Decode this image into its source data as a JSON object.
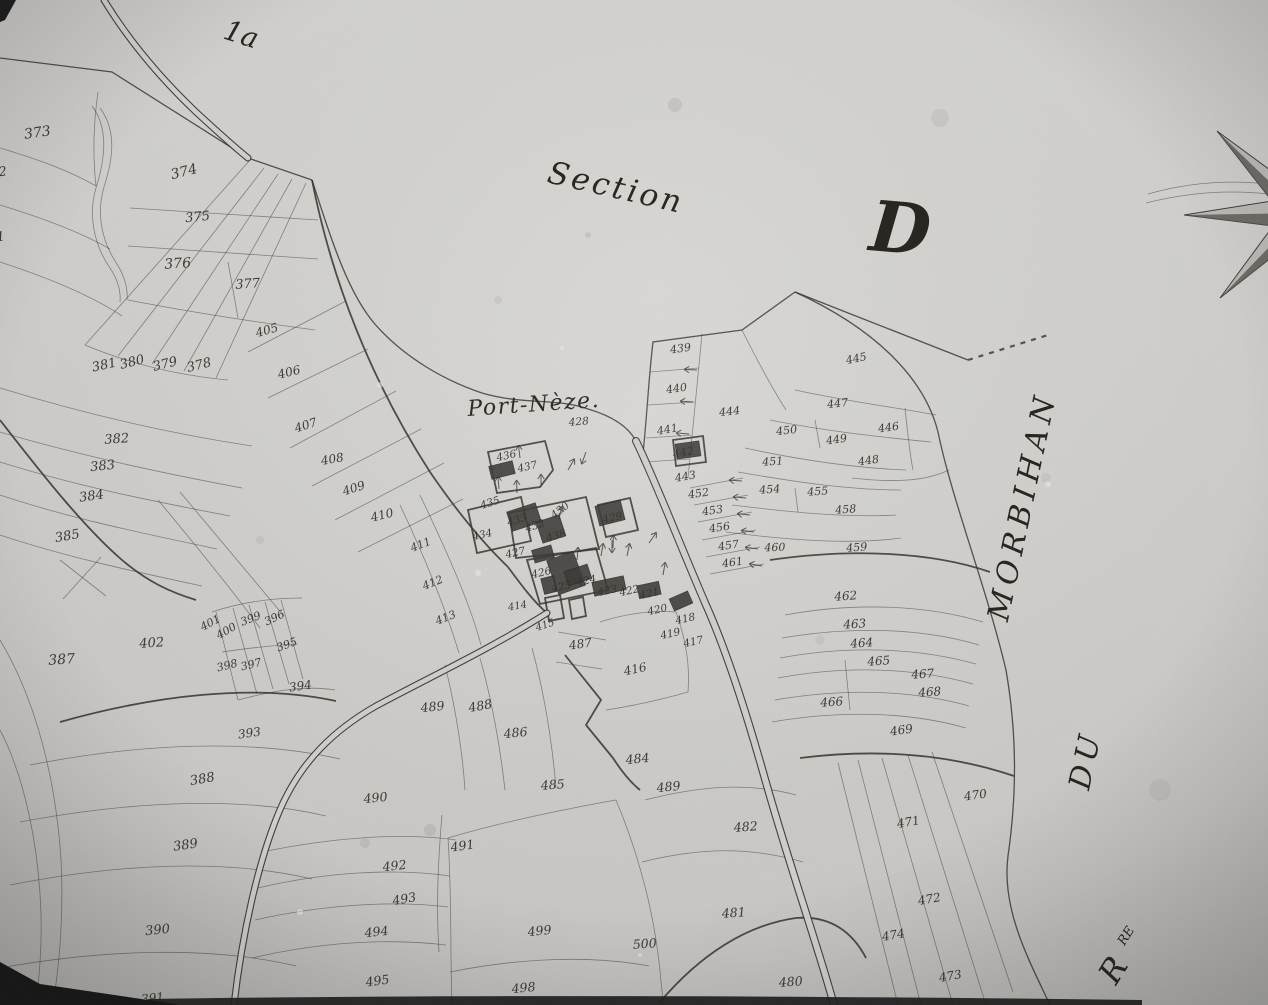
{
  "map": {
    "corner_label": "1a",
    "section_label": "Section",
    "section_letter": "D",
    "place_name": "Port-Nèze.",
    "place_parcel": "428",
    "water_name_morbihan": "MORBIHAN",
    "water_name_du": "DU",
    "water_name_r": "R",
    "water_name_r_sup": "RE"
  },
  "colors": {
    "paper": "#d3d2cf",
    "ink": "#2d2b27",
    "accent_dark": "#161616"
  },
  "parcels": [
    [
      "373",
      38,
      137,
      -8,
      14
    ],
    [
      "374",
      185,
      176,
      -14,
      14
    ],
    [
      "375",
      198,
      221,
      -6,
      13
    ],
    [
      "376",
      178,
      268,
      -4,
      14
    ],
    [
      "377",
      248,
      288,
      -4,
      13
    ],
    [
      "372",
      -5,
      177,
      -8,
      13
    ],
    [
      "371",
      -7,
      242,
      -8,
      13
    ],
    [
      "381",
      105,
      369,
      -12,
      13
    ],
    [
      "380",
      133,
      366,
      -14,
      13
    ],
    [
      "379",
      166,
      368,
      -14,
      13
    ],
    [
      "378",
      200,
      369,
      -14,
      13
    ],
    [
      "382",
      117,
      443,
      -4,
      13
    ],
    [
      "383",
      103,
      470,
      -6,
      13
    ],
    [
      "384",
      92,
      500,
      -8,
      13
    ],
    [
      "385",
      68,
      540,
      -10,
      13
    ],
    [
      "387",
      62,
      664,
      -4,
      14
    ],
    [
      "402",
      152,
      647,
      -4,
      13
    ],
    [
      "401",
      212,
      626,
      -28,
      11
    ],
    [
      "400",
      228,
      634,
      -30,
      11
    ],
    [
      "399",
      252,
      622,
      -22,
      11
    ],
    [
      "396",
      276,
      621,
      -26,
      11
    ],
    [
      "395",
      288,
      648,
      -20,
      11
    ],
    [
      "398",
      228,
      669,
      -14,
      11
    ],
    [
      "397",
      252,
      668,
      -14,
      11
    ],
    [
      "394",
      301,
      690,
      -8,
      12
    ],
    [
      "393",
      250,
      737,
      -8,
      12
    ],
    [
      "388",
      203,
      783,
      -10,
      13
    ],
    [
      "389",
      186,
      849,
      -8,
      13
    ],
    [
      "390",
      158,
      934,
      -6,
      13
    ],
    [
      "391",
      153,
      1002,
      -6,
      12
    ],
    [
      "405",
      268,
      334,
      -16,
      12
    ],
    [
      "406",
      290,
      376,
      -14,
      12
    ],
    [
      "407",
      307,
      429,
      -18,
      12
    ],
    [
      "408",
      333,
      463,
      -10,
      12
    ],
    [
      "409",
      355,
      492,
      -18,
      12
    ],
    [
      "410",
      383,
      519,
      -14,
      12
    ],
    [
      "411",
      422,
      548,
      -22,
      11
    ],
    [
      "412",
      434,
      586,
      -22,
      11
    ],
    [
      "413",
      447,
      621,
      -22,
      11
    ],
    [
      "414",
      518,
      609,
      -10,
      10
    ],
    [
      "415",
      546,
      628,
      -18,
      10
    ],
    [
      "416",
      636,
      673,
      -12,
      12
    ],
    [
      "435",
      491,
      506,
      -18,
      10.5
    ],
    [
      "436",
      507,
      459,
      -12,
      10.5
    ],
    [
      "437",
      528,
      470,
      -12,
      10.5
    ],
    [
      "434",
      483,
      538,
      -12,
      10.5
    ],
    [
      "433",
      518,
      523,
      -18,
      10.5
    ],
    [
      "432",
      536,
      529,
      -18,
      10.5
    ],
    [
      "438",
      557,
      539,
      -18,
      10.5
    ],
    [
      "430",
      562,
      513,
      -38,
      10.5
    ],
    [
      "429",
      613,
      521,
      -12,
      10.5
    ],
    [
      "427",
      516,
      556,
      -12,
      10.5
    ],
    [
      "426",
      542,
      576,
      -12,
      10.5
    ],
    [
      "425",
      562,
      590,
      -12,
      10.5
    ],
    [
      "424",
      587,
      584,
      -12,
      10.5
    ],
    [
      "423",
      608,
      594,
      -12,
      10.5
    ],
    [
      "422",
      630,
      594,
      -12,
      10.5
    ],
    [
      "421",
      650,
      597,
      -12,
      10.5
    ],
    [
      "420",
      658,
      613,
      -12,
      10.5
    ],
    [
      "419",
      671,
      637,
      -12,
      10.5
    ],
    [
      "418",
      686,
      622,
      -12,
      10.5
    ],
    [
      "417",
      694,
      645,
      -12,
      10.5
    ],
    [
      "428",
      579,
      425,
      -4,
      10.5
    ],
    [
      "439",
      681,
      352,
      -8,
      11
    ],
    [
      "440",
      677,
      392,
      -8,
      11
    ],
    [
      "441",
      668,
      433,
      -10,
      11
    ],
    [
      "442",
      684,
      456,
      -10,
      11
    ],
    [
      "443",
      686,
      480,
      -10,
      11
    ],
    [
      "444",
      730,
      415,
      -6,
      11
    ],
    [
      "445",
      857,
      362,
      -12,
      11
    ],
    [
      "446",
      889,
      431,
      -8,
      11
    ],
    [
      "447",
      838,
      407,
      -6,
      11
    ],
    [
      "448",
      869,
      464,
      -8,
      11
    ],
    [
      "449",
      837,
      443,
      -8,
      11
    ],
    [
      "450",
      787,
      434,
      -6,
      11
    ],
    [
      "451",
      773,
      465,
      -4,
      11
    ],
    [
      "452",
      699,
      497,
      -8,
      11
    ],
    [
      "453",
      713,
      514,
      -8,
      11
    ],
    [
      "454",
      770,
      493,
      -4,
      11
    ],
    [
      "455",
      818,
      495,
      -4,
      11
    ],
    [
      "456",
      720,
      531,
      -8,
      11
    ],
    [
      "457",
      729,
      549,
      -8,
      11
    ],
    [
      "458",
      846,
      513,
      -4,
      11
    ],
    [
      "459",
      857,
      551,
      -4,
      11
    ],
    [
      "460",
      775,
      551,
      -2,
      11
    ],
    [
      "461",
      733,
      566,
      -8,
      11
    ],
    [
      "462",
      846,
      600,
      -4,
      12
    ],
    [
      "463",
      855,
      628,
      -4,
      12
    ],
    [
      "464",
      862,
      647,
      -4,
      12
    ],
    [
      "465",
      879,
      665,
      -4,
      12
    ],
    [
      "466",
      832,
      706,
      -4,
      12
    ],
    [
      "467",
      923,
      678,
      -4,
      12
    ],
    [
      "468",
      930,
      696,
      -4,
      12
    ],
    [
      "469",
      902,
      734,
      -8,
      12
    ],
    [
      "470",
      976,
      799,
      -8,
      12
    ],
    [
      "471",
      909,
      826,
      -10,
      12
    ],
    [
      "472",
      930,
      903,
      -10,
      12
    ],
    [
      "473",
      951,
      980,
      -10,
      12
    ],
    [
      "474",
      894,
      939,
      -10,
      12
    ],
    [
      "480",
      791,
      986,
      -4,
      12.5
    ],
    [
      "481",
      734,
      917,
      -4,
      12.5
    ],
    [
      "482",
      746,
      831,
      -4,
      12.5
    ],
    [
      "484",
      638,
      763,
      -6,
      12.5
    ],
    [
      "485",
      553,
      789,
      -4,
      12.5
    ],
    [
      "486",
      516,
      737,
      -6,
      12.5
    ],
    [
      "487",
      581,
      648,
      -8,
      12
    ],
    [
      "488",
      481,
      710,
      -10,
      12.5
    ],
    [
      "489",
      433,
      711,
      -6,
      12.5
    ],
    [
      "489",
      669,
      791,
      -6,
      12.5
    ],
    [
      "490",
      376,
      802,
      -6,
      12.5
    ],
    [
      "491",
      463,
      850,
      -8,
      12.5
    ],
    [
      "492",
      395,
      870,
      -6,
      12.5
    ],
    [
      "493",
      405,
      903,
      -10,
      12.5
    ],
    [
      "494",
      377,
      936,
      -6,
      12.5
    ],
    [
      "495",
      378,
      985,
      -8,
      12.5
    ],
    [
      "498",
      524,
      992,
      -6,
      12.5
    ],
    [
      "499",
      540,
      935,
      -6,
      12.5
    ],
    [
      "500",
      645,
      948,
      -4,
      12.5
    ]
  ],
  "geometry": {
    "coast": [
      "M 0,58 L 112,72 L 248,158 L 312,180",
      "M 312,180 C 332,242 348,292 374,323 C 404,358 446,381 482,393 C 522,405 558,398 588,409 C 612,416 628,426 636,441 L 642,462",
      "M 642,462 C 647,420 648,384 653,342 L 742,330 L 795,292",
      "M 795,292 C 858,317 930,345 968,360",
      "M 795,292 C 878,330 925,380 938,432 C 952,500 986,586 1006,670 C 1018,740 1016,800 1008,856 C 1001,910 1030,962 1050,1005"
    ],
    "thin": [
      "M 0,148 C 40,160 70,171 96,186",
      "M 0,205 C 46,219 82,233 110,249",
      "M 0,262 C 52,279 92,296 122,316",
      "M 96,186 C 92,150 94,120 98,92",
      "M 130,208 L 318,220",
      "M 128,246 L 318,259",
      "M 228,262 L 238,318",
      "M 128,300 C 190,312 255,322 315,330",
      "M 250,160 L 85,345",
      "M 264,168 L 118,356",
      "M 278,174 L 152,364",
      "M 292,179 L 184,371",
      "M 306,183 L 216,378",
      "M 85,345 C 135,366 185,376 228,380",
      "M 0,388 C 85,414 172,434 252,446",
      "M 0,432 C 82,456 162,473 242,488",
      "M 0,462 C 76,486 152,501 230,516",
      "M 0,495 C 72,519 142,533 217,549",
      "M 0,535 C 66,557 132,571 202,586",
      "M 158,500 C 198,548 232,590 260,628",
      "M 180,492 C 220,540 254,580 284,616",
      "M 212,612 C 242,602 272,598 302,598",
      "M 216,612 L 238,700",
      "M 233,608 L 257,694",
      "M 249,605 L 273,689",
      "M 265,602 L 289,684",
      "M 281,600 L 303,679",
      "M 222,652 C 250,648 275,645 298,644",
      "M 238,700 C 272,691 305,685 335,690",
      "M 30,765 C 142,743 252,739 340,759",
      "M 20,822 C 132,801 242,796 326,816",
      "M 10,885 C 122,863 227,859 312,879",
      "M 0,968 C 106,949 212,946 296,966",
      "M 0,640 C 36,700 56,780 61,860 C 64,920 59,965 53,1005",
      "M 0,730 C 26,780 39,850 41,915 C 42,950 39,980 36,1005",
      "M 60,560 L 106,596",
      "M 101,557 L 63,599",
      "M 100,108 C 118,132 112,162 104,187 C 96,214 102,242 117,264 C 125,277 128,289 127,300",
      "M 92,106 C 110,130 104,162 96,188 C 88,215 94,245 110,268 C 118,280 121,291 120,302",
      "M 248,352 L 346,301",
      "M 268,398 L 368,349",
      "M 290,448 L 396,391",
      "M 312,486 L 421,429",
      "M 335,520 L 444,463",
      "M 358,552 L 463,499",
      "M 400,505 C 426,560 446,610 459,653",
      "M 420,495 C 446,550 469,600 481,645",
      "M 445,665 C 455,706 462,746 465,790",
      "M 480,658 C 492,701 500,746 505,790",
      "M 532,648 C 545,696 552,741 556,788",
      "M 558,632 L 606,640",
      "M 556,662 L 602,669",
      "M 262,852 C 330,838 400,832 456,840",
      "M 258,888 C 325,872 395,868 450,876",
      "M 255,920 C 322,905 392,900 448,907",
      "M 252,958 C 320,942 390,938 446,945",
      "M 442,815 C 438,862 436,906 439,952",
      "M 448,838 C 502,822 560,810 616,800",
      "M 448,838 C 452,900 450,950 452,1005",
      "M 616,800 C 641,860 656,920 661,982 C 662,990 663,1000 663,1005",
      "M 450,972 C 520,958 590,955 649,966",
      "M 702,334 C 697,386 692,436 688,478",
      "M 650,372 L 699,368",
      "M 648,405 L 695,402",
      "M 646,438 L 691,435",
      "M 645,462 L 689,459",
      "M 795,390 C 850,402 900,408 936,415",
      "M 770,420 C 830,432 890,438 931,442",
      "M 905,408 C 908,436 910,456 913,470",
      "M 815,420 L 820,448",
      "M 852,478 C 896,483 926,481 949,470",
      "M 745,448 C 800,460 856,468 906,470",
      "M 738,472 C 795,482 850,490 901,490",
      "M 732,505 C 790,512 846,518 896,515",
      "M 726,532 C 788,540 849,545 901,538",
      "M 795,488 L 798,512",
      "M 742,330 C 758,362 772,388 786,410",
      "M 690,488 L 743,478",
      "M 694,505 L 748,495",
      "M 698,522 L 752,512",
      "M 702,540 L 756,530",
      "M 706,557 L 760,547",
      "M 710,574 L 764,564",
      "M 785,615 C 856,602 926,605 983,622",
      "M 782,638 C 852,626 922,628 979,645",
      "M 780,658 C 850,645 918,648 976,664",
      "M 778,678 C 848,665 915,668 973,684",
      "M 775,700 C 845,688 912,690 969,706",
      "M 845,660 L 850,710",
      "M 772,722 C 842,710 910,712 966,728",
      "M 838,763 L 898,1005",
      "M 858,760 L 921,1005",
      "M 882,758 L 953,1005",
      "M 908,755 L 986,1005",
      "M 932,752 L 1013,992",
      "M 645,800 C 700,786 748,782 796,795",
      "M 642,862 C 698,848 748,846 803,862",
      "M 600,622 C 625,614 650,610 676,612",
      "M 676,612 C 686,640 690,665 688,692",
      "M 688,692 C 660,700 632,706 606,710",
      "M 1148,194 C 1190,182 1230,180 1268,184",
      "M 1146,203 C 1190,192 1232,190 1268,194"
    ],
    "bold": [
      "M 60,722 C 152,696 252,683 336,701",
      "M 0,420 C 45,478 85,528 122,560 C 148,582 170,592 196,600",
      "M 312,180 C 332,282 372,382 430,472 C 456,510 482,542 508,567",
      "M 508,567 C 522,586 534,602 547,613",
      "M 770,560 C 852,548 932,552 990,572",
      "M 800,758 C 880,748 952,755 1014,776",
      "M 565,655 L 601,700 L 586,725 L 613,758",
      "M 613,758 C 622,772 630,782 640,790",
      "M 660,1002 C 700,955 746,925 796,918 C 831,915 853,933 866,958",
      "M 488,452 L 545,441 L 553,470 L 540,487 L 497,493 Z",
      "M 468,510 L 521,497 L 531,541 L 477,553 Z",
      "M 509,513 L 586,497 L 599,549 L 516,558 Z",
      "M 527,560 L 596,548 L 608,590 L 540,604 Z",
      "M 598,505 L 630,498 L 638,530 L 606,537 Z",
      "M 545,598 L 560,595 L 564,618 L 549,621 Z",
      "M 569,600 L 583,597 L 586,616 L 572,619 Z",
      "M 673,440 L 703,436 L 706,462 L 676,466 Z"
    ],
    "roads": [
      {
        "d": "M 636,441 C 656,482 680,545 706,605 C 727,652 746,712 763,772 C 790,868 816,940 834,1005",
        "w": 8
      },
      {
        "d": "M 547,613 C 492,648 428,678 376,706 C 334,730 300,762 279,812 C 258,862 242,935 234,1005",
        "w": 7
      },
      {
        "d": "M 104,0 C 126,36 156,74 196,112 C 221,135 238,150 248,158",
        "w": 7
      }
    ],
    "dashed": [
      "M 968,360 L 1048,335"
    ],
    "buildings": [
      [
        524,
        517,
        30,
        20,
        -18
      ],
      [
        551,
        529,
        24,
        22,
        -18
      ],
      [
        610,
        513,
        26,
        20,
        -14
      ],
      [
        543,
        554,
        20,
        13,
        -16
      ],
      [
        566,
        573,
        28,
        36,
        -20
      ],
      [
        549,
        585,
        13,
        16,
        -14
      ],
      [
        578,
        575,
        24,
        15,
        -18
      ],
      [
        609,
        586,
        32,
        14,
        -12
      ],
      [
        649,
        590,
        22,
        13,
        -12
      ],
      [
        681,
        601,
        20,
        13,
        -24
      ],
      [
        688,
        450,
        24,
        15,
        -8
      ],
      [
        502,
        470,
        24,
        13,
        -14
      ]
    ],
    "arrows": [
      [
        742,
        481,
        184
      ],
      [
        746,
        498,
        185
      ],
      [
        750,
        515,
        186
      ],
      [
        754,
        532,
        187
      ],
      [
        758,
        549,
        188
      ],
      [
        762,
        566,
        190
      ],
      [
        697,
        370,
        183
      ],
      [
        693,
        402,
        184
      ],
      [
        689,
        434,
        185
      ],
      [
        499,
        489,
        -95
      ],
      [
        517,
        493,
        -92
      ],
      [
        541,
        487,
        -90
      ],
      [
        520,
        458,
        -97
      ],
      [
        559,
        519,
        -78
      ],
      [
        577,
        560,
        -85
      ],
      [
        601,
        556,
        -80
      ],
      [
        627,
        556,
        -78
      ],
      [
        649,
        543,
        -55
      ],
      [
        663,
        575,
        -80
      ],
      [
        613,
        548,
        -88
      ],
      [
        612,
        540,
        90
      ],
      [
        568,
        470,
        -60
      ],
      [
        586,
        452,
        110
      ]
    ],
    "compass": {
      "outline": "M 1314,183 L 1301,95 L 1289,184 L 1217,131 L 1272,201 L 1184,215 L 1273,226 L 1220,298 L 1290,243 L 1304,331 L 1315,242 L 1390,213 Z",
      "shade": [
        "M 1217,131 L 1272,201 L 1302,213 Z",
        "M 1184,215 L 1273,226 L 1302,213 Z",
        "M 1220,298 L 1290,243 L 1302,213 Z",
        "M 1301,95 L 1314,183 L 1302,213 Z"
      ]
    },
    "edges": {
      "bottom_bar": "M 148,999 C 420,995 760,995 1142,1000 L 1142,1005 L 148,1005 Z",
      "corner_bl": "M 0,962 L 40,984 L 175,1004 L 178,1005 L 0,1005 Z",
      "corner_tl": "M 0,0 L 16,0 L 5,20 L 0,22 Z"
    },
    "spots_dark": [
      [
        675,
        105,
        7,
        0.1
      ],
      [
        940,
        118,
        9,
        0.08
      ],
      [
        498,
        300,
        4,
        0.08
      ],
      [
        430,
        830,
        6,
        0.1
      ],
      [
        1160,
        790,
        11,
        0.06
      ],
      [
        588,
        235,
        3,
        0.1
      ],
      [
        365,
        843,
        5,
        0.09
      ],
      [
        1046,
        478,
        5,
        0.07
      ],
      [
        820,
        640,
        5,
        0.06
      ],
      [
        260,
        540,
        4,
        0.07
      ]
    ],
    "spots_light": [
      [
        380,
        385,
        3
      ],
      [
        478,
        573,
        3
      ],
      [
        562,
        348,
        2
      ],
      [
        1048,
        484,
        3
      ],
      [
        300,
        912,
        3
      ],
      [
        640,
        955,
        2
      ]
    ]
  }
}
